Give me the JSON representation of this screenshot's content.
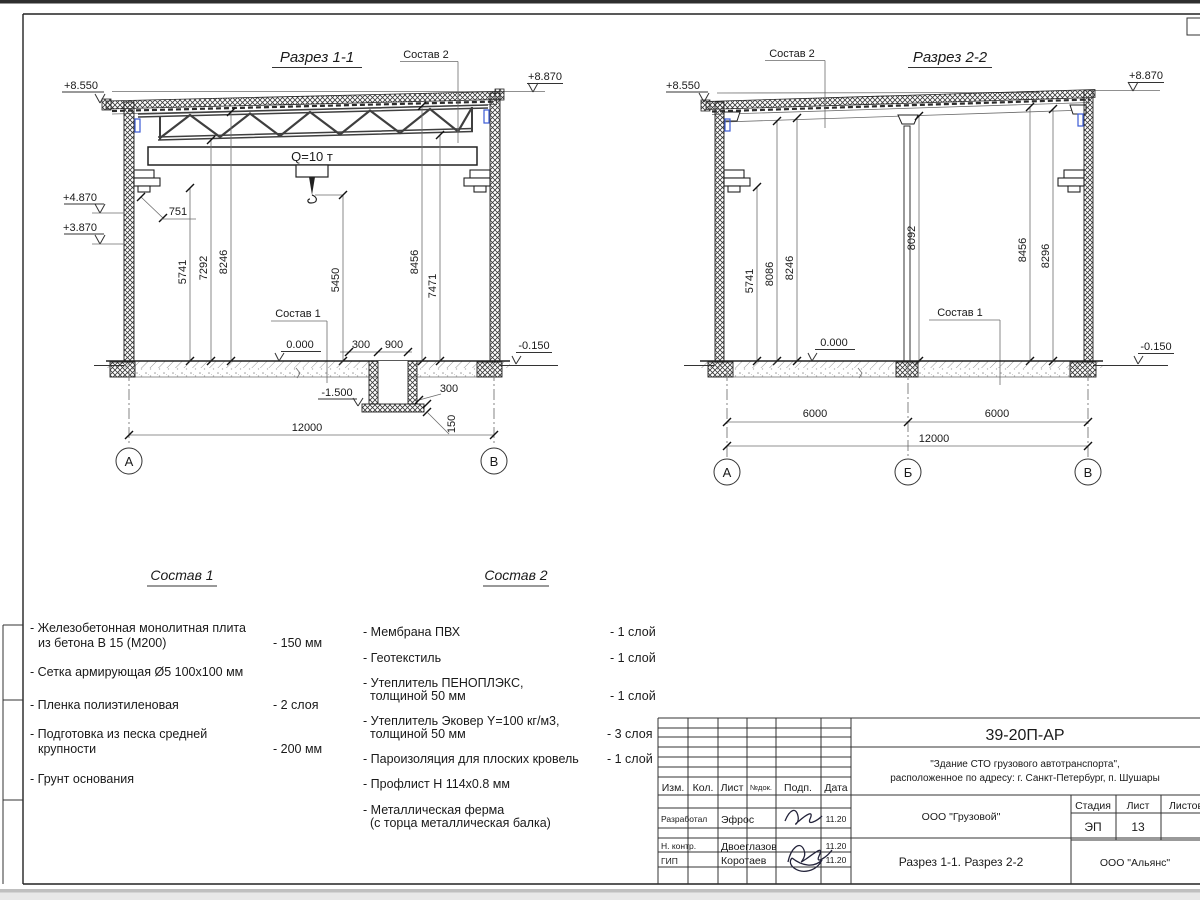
{
  "drawing": {
    "section1": {
      "title": "Разрез 1-1",
      "crane": "Q=10 т",
      "callout_sostav2": "Состав 2",
      "callout_sostav1": "Состав 1",
      "elev_top_left": "+8.550",
      "elev_top_right": "+8.870",
      "elev_rail": "+4.870",
      "elev_bracket": "+3.870",
      "elev_floor": "0.000",
      "elev_ground": "-0.150",
      "elev_pit": "-1.500",
      "dim_bracket": "751",
      "dims_vertical": [
        "5741",
        "7292",
        "8246",
        "5450",
        "8456",
        "7471"
      ],
      "dims_pit": [
        "300",
        "900",
        "300",
        "150"
      ],
      "dim_span": "12000",
      "axes": [
        "А",
        "В"
      ]
    },
    "section2": {
      "title": "Разрез 2-2",
      "callout_sostav2": "Состав 2",
      "callout_sostav1": "Состав 1",
      "elev_top_left": "+8.550",
      "elev_top_right": "+8.870",
      "elev_floor": "0.000",
      "elev_ground": "-0.150",
      "dims_vertical": [
        "5741",
        "8086",
        "8246",
        "8092",
        "8456",
        "8296"
      ],
      "dims_span": [
        "6000",
        "6000",
        "12000"
      ],
      "axes": [
        "А",
        "Б",
        "В"
      ]
    },
    "sostav1": {
      "title": "Состав 1",
      "items": [
        {
          "l1": "- Железобетонная  монолитная плита",
          "l2": "из бетона В 15 (М200)",
          "v": "- 150 мм"
        },
        {
          "l1": "- Сетка армирующая Ø5 100х100 мм",
          "l2": "",
          "v": ""
        },
        {
          "l1": "- Пленка полиэтиленовая",
          "l2": "",
          "v": "-  2 слоя"
        },
        {
          "l1": "- Подготовка из песка средней",
          "l2": "крупности",
          "v": "- 200 мм"
        },
        {
          "l1": "- Грунт основания",
          "l2": "",
          "v": ""
        }
      ]
    },
    "sostav2": {
      "title": "Состав 2",
      "items": [
        {
          "l1": "- Мембрана ПВХ",
          "l2": "",
          "v": "- 1 слой"
        },
        {
          "l1": "- Геотекстиль",
          "l2": "",
          "v": "- 1 слой"
        },
        {
          "l1": "- Утеплитель ПЕНОПЛЭКС,",
          "l2": "толщиной 50 мм",
          "v": "- 1 слой"
        },
        {
          "l1": "- Утеплитель Эковер Y=100 кг/м3,",
          "l2": "толщиной 50 мм",
          "v": "- 3 слоя"
        },
        {
          "l1": "- Пароизоляция для плоских кровель",
          "l2": "",
          "v": "- 1 слой"
        },
        {
          "l1": "- Профлист Н 114х0.8 мм",
          "l2": "",
          "v": ""
        },
        {
          "l1": "- Металлическая ферма",
          "l2": "(с торца металлическая балка)",
          "v": ""
        }
      ]
    },
    "titleblock": {
      "code": "39-20П-АР",
      "object1": "\"Здание СТО грузового автотранспорта\",",
      "object2": "расположенное по адресу: г. Санкт-Петербург, п. Шушары",
      "cols": [
        "Изм.",
        "Кол.",
        "Лист",
        "№док.",
        "Подп.",
        "Дата"
      ],
      "rows": [
        {
          "role": "Разработал",
          "name": "Эфрос",
          "date": "11.20"
        },
        {
          "role": "Н. контр.",
          "name": "Двоеглазов",
          "date": "11.20"
        },
        {
          "role": "ГИП",
          "name": "Коротаев",
          "date": "11.20"
        }
      ],
      "client": "ООО \"Грузовой\"",
      "stage_label": "Стадия",
      "sheet_label": "Лист",
      "sheets_label": "Листов",
      "stage": "ЭП",
      "sheet_no": "13",
      "doc_title": "Разрез 1-1. Разрез 2-2",
      "company": "ООО \"Альянс\""
    }
  }
}
